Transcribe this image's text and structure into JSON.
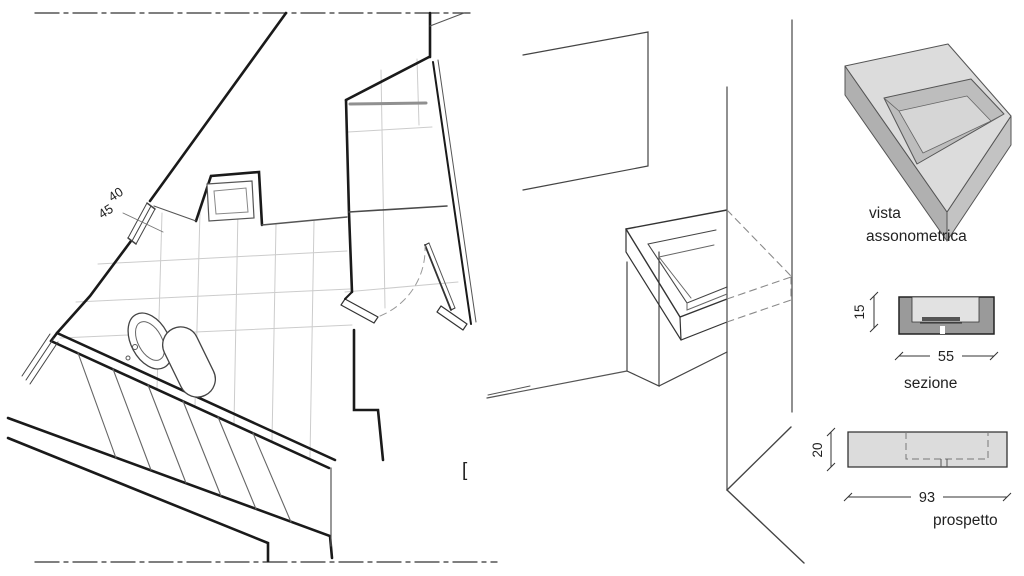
{
  "plan": {
    "dim_upper": "40",
    "dim_lower": "45",
    "stray_glyph": "["
  },
  "axonometric_view": {
    "label_line1": "vista",
    "label_line2": "assonometrica"
  },
  "section_view": {
    "dim_height": "15",
    "dim_width": "55",
    "label": "sezione"
  },
  "elevation_view": {
    "dim_height": "20",
    "dim_width": "93",
    "label": "prospetto"
  },
  "colors": {
    "wall_line": "#1a1a1a",
    "thin_line": "#555555",
    "tile_line": "#cccccc",
    "hidden_line": "#8a8a8a",
    "text": "#222222",
    "surface_light": "#dcdcdc",
    "surface_mid": "#c3c3c3",
    "surface_dark": "#b0b0b0",
    "section_body": "#9a9a9a",
    "section_cavity": "#e2e2e2"
  }
}
